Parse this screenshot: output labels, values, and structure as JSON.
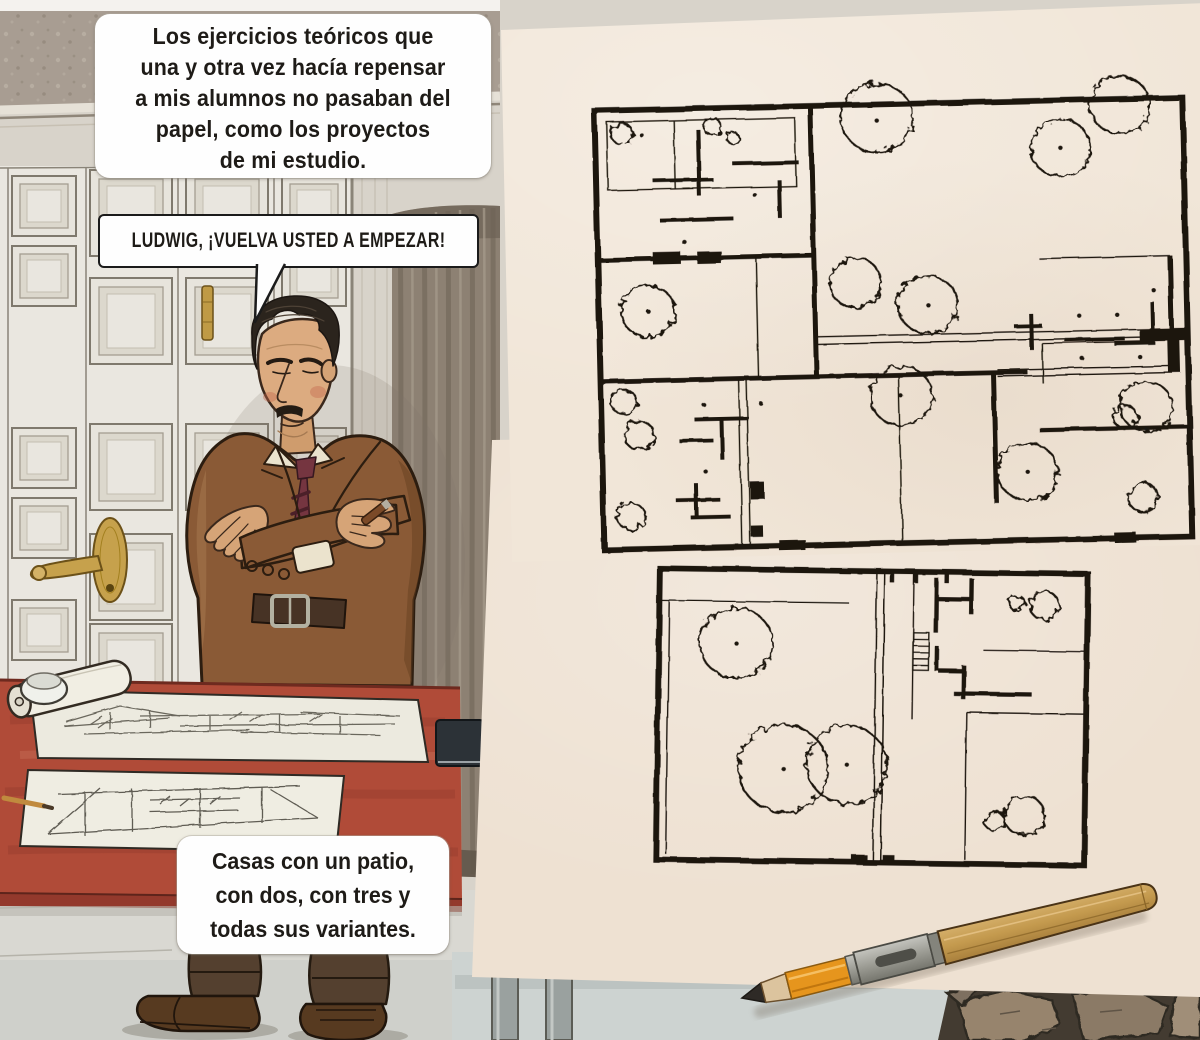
{
  "panel": {
    "type": "comic-panel",
    "language": "es",
    "captions": {
      "narration_top": {
        "lines": [
          "Los ejercicios teóricos que",
          "una y otra vez hacía repensar",
          "a mis alumnos no pasaban del",
          "papel, como los proyectos",
          "de mi estudio."
        ]
      },
      "speech_bubble": {
        "text": "LUDWIG, ¡VUELVA USTED A EMPEZAR!"
      },
      "narration_bottom": {
        "lines": [
          "Casas con un patio,",
          "con dos, con tres y",
          "todas sus variantes."
        ]
      }
    },
    "artwork": {
      "character": "architect-standing-arms-crossed-holding-cigar",
      "setting": "studio-with-paneled-doors-curtain-and-red-drafting-table",
      "overlays": [
        "courtyard-houses-site-plan-sheet",
        "single-courtyard-house-plan-sheet",
        "pencil-extender",
        "stone-paving"
      ]
    },
    "colors": {
      "paper": "#f1e6d8",
      "ink": "#1c1510",
      "desk_red": "#b04b38",
      "jacket_brown": "#8a5a36",
      "tie_maroon": "#753540",
      "wallpaper": "#a89d92",
      "wall": "#d8d3ca",
      "door": "#eae7e0",
      "curtain": "#8d8173",
      "floor": "#d9d8d2",
      "floor_blue": "#cdd3d1",
      "pencil_wood": "#c9a35e",
      "pencil_orange": "#e6951d"
    }
  }
}
